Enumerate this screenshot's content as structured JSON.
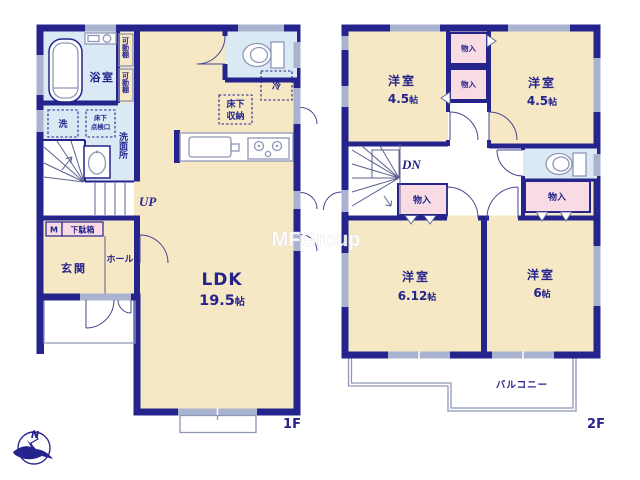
{
  "watermark": "MFGroup",
  "compass": {
    "north_label": "N"
  },
  "floor1": {
    "floor_label": "1F",
    "bathroom_label": "浴室",
    "washroom_label": "洗面所",
    "washer_label": "洗",
    "underfloor_hatch_line1": "床下",
    "underfloor_hatch_line2": "点検口",
    "movable_shelf_top": "可動棚",
    "movable_shelf_bottom": "可動棚",
    "fridge_label": "冷",
    "underfloor_storage_line1": "床下",
    "underfloor_storage_line2": "収納",
    "ldk_name": "LDK",
    "ldk_size": "19.5",
    "ldk_size_unit": "帖",
    "stairs_up_label": "UP",
    "meter_label": "M",
    "shoebox_label": "下駄箱",
    "entrance_label": "玄関",
    "hall_label": "ホール"
  },
  "floor2": {
    "floor_label": "2F",
    "stairs_down_label": "DN",
    "bedroom1": {
      "name": "洋室",
      "size": "4.5",
      "unit": "帖"
    },
    "bedroom2": {
      "name": "洋室",
      "size": "4.5",
      "unit": "帖"
    },
    "bedroom3": {
      "name": "洋室",
      "size": "6.12",
      "unit": "帖"
    },
    "bedroom4": {
      "name": "洋室",
      "size": "6",
      "unit": "帖"
    },
    "closet_top1": "物入",
    "closet_top2": "物入",
    "closet_hall_left": "物入",
    "closet_hall_right": "物入",
    "balcony_label": "バルコニー"
  },
  "colors": {
    "wall": "#24248c",
    "floor": "#f6e7c5",
    "wet_room": "#dbe9f4",
    "closet": "#f8dbe3",
    "window": "#a9b2cf",
    "thin_line": "#8f96b8"
  }
}
